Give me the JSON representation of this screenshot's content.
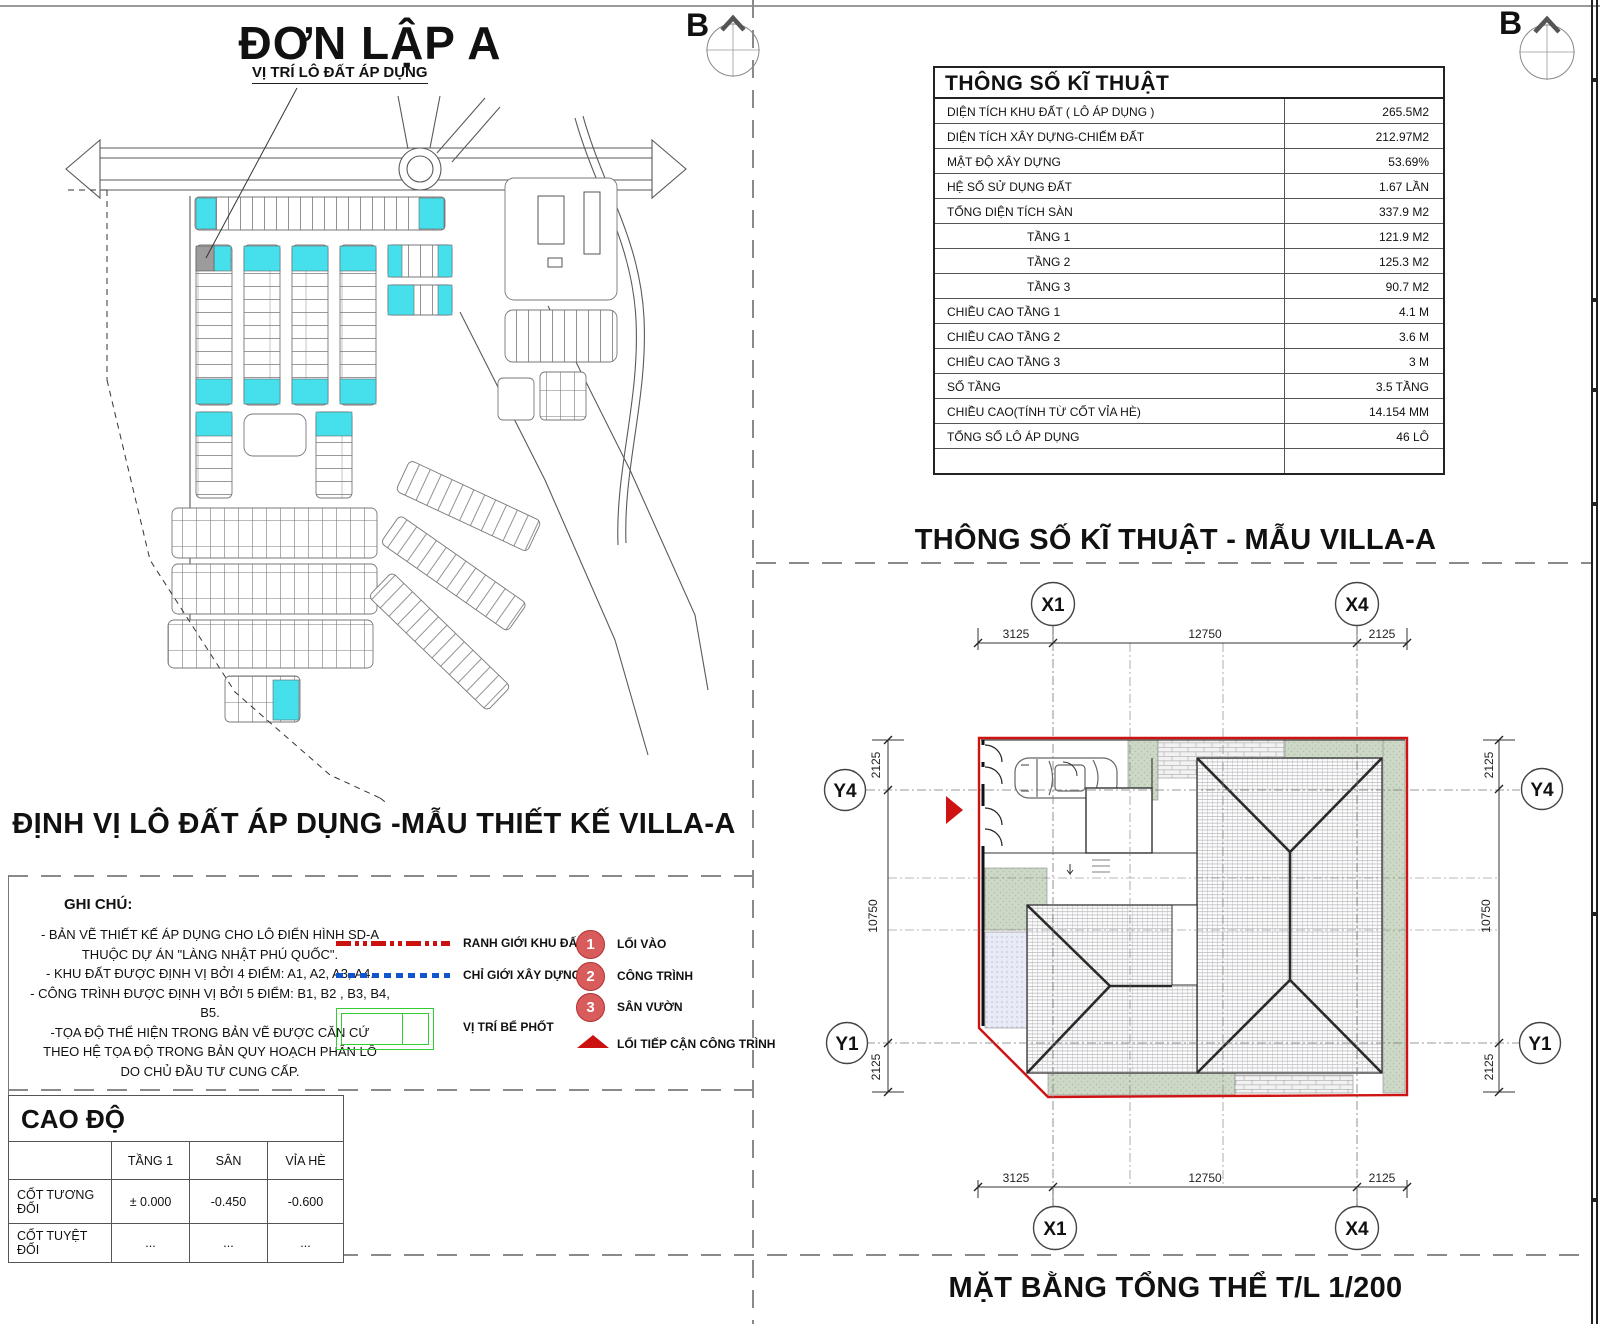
{
  "meta": {
    "north_label": "B"
  },
  "colors": {
    "highlight_lot_cyan": "#45E0EC",
    "selected_lot_gray": "#9C9C9C",
    "boundary_red": "#CF1212",
    "building_line_blue": "#1155CC",
    "septic_green": "#33CC33",
    "garden_sage": "#CDD8C6"
  },
  "left": {
    "title": "ĐƠN LẬP A",
    "map_label": "VỊ TRÍ LÔ ĐẤT ÁP DỤNG",
    "heading": "ĐỊNH VỊ LÔ ĐẤT ÁP DỤNG -MẪU THIẾT KẾ  VILLA-A",
    "notes": {
      "title": "GHI CHÚ:",
      "lines": [
        "- BẢN VẼ THIẾT KẾ ÁP DỤNG CHO LÔ ĐIỂN HÌNH SD-A",
        "THUỘC DỰ ÁN \"LÀNG NHẬT PHÚ QUỐC\".",
        "- KHU ĐẤT ĐƯỢC ĐỊNH VỊ BỞI 4 ĐIỂM: A1, A2, A3, A4.",
        "- CÔNG TRÌNH ĐƯỢC ĐỊNH VỊ BỞI 5 ĐIỂM: B1, B2 , B3, B4, B5.",
        "-TỌA ĐỘ THỂ HIỆN TRONG BẢN VẼ ĐƯỢC CĂN CỨ",
        "THEO HỆ TỌA ĐỘ TRONG BẢN QUY HOẠCH PHÂN LÔ",
        "DO CHỦ ĐẦU TƯ CUNG CẤP."
      ]
    },
    "legend": {
      "boundary": "RANH GIỚI KHU ĐẤT",
      "building_line": "CHỈ GIỚI XÂY DỰNG",
      "septic": "VỊ TRÍ BỂ PHỐT",
      "numbered": [
        {
          "num": "1",
          "label": "LỐI VÀO"
        },
        {
          "num": "2",
          "label": "CÔNG TRÌNH"
        },
        {
          "num": "3",
          "label": "SÂN VƯỜN"
        }
      ],
      "access": "LỐI TIẾP CẬN CÔNG TRÌNH"
    },
    "cao_do": {
      "title": "CAO ĐỘ",
      "col_headers": [
        "",
        "TẦNG 1",
        "SÂN",
        "VỈA HÈ"
      ],
      "rows": [
        {
          "label": "CỐT TƯƠNG ĐỐI",
          "values": [
            "± 0.000",
            "-0.450",
            "-0.600"
          ]
        },
        {
          "label": "CỐT TUYỆT ĐỐI",
          "values": [
            "...",
            "...",
            "..."
          ]
        }
      ]
    }
  },
  "right": {
    "specs": {
      "title": "THÔNG SỐ KĨ THUẬT",
      "rows": [
        {
          "label": "DIỆN TÍCH KHU ĐẤT ( LÔ ÁP DỤNG )",
          "value": "265.5M2"
        },
        {
          "label": "DIỆN TÍCH XÂY DỰNG-CHIẾM ĐẤT",
          "value": "212.97M2"
        },
        {
          "label": "MẬT ĐỘ XÂY DỰNG",
          "value": "53.69%"
        },
        {
          "label": "HỆ SỐ SỬ DỤNG ĐẤT",
          "value": "1.67 LẦN"
        },
        {
          "label": "TỔNG DIỆN TÍCH SÀN",
          "value": "337.9 M2"
        },
        {
          "label": "TẦNG 1",
          "value": "121.9 M2"
        },
        {
          "label": "TẦNG 2",
          "value": "125.3 M2"
        },
        {
          "label": "TẦNG 3",
          "value": "90.7 M2"
        },
        {
          "label": "CHIỀU CAO TẦNG 1",
          "value": "4.1 M"
        },
        {
          "label": "CHIỀU CAO TẦNG 2",
          "value": "3.6 M"
        },
        {
          "label": "CHIỀU CAO TẦNG 3",
          "value": "3 M"
        },
        {
          "label": "SỐ TẦNG",
          "value": "3.5 TẦNG"
        },
        {
          "label": "CHIỀU CAO(TÍNH TỪ CỐT VỈA HÈ)",
          "value": "14.154 MM"
        },
        {
          "label": "TỔNG SỐ LÔ ÁP DỤNG",
          "value": "46 LÔ"
        }
      ]
    },
    "specs_heading": "THÔNG SỐ KĨ THUẬT - MẪU VILLA-A",
    "plan": {
      "grid_x": [
        "X1",
        "X4"
      ],
      "grid_y": [
        "Y4",
        "Y1"
      ],
      "dims_top": [
        "3125",
        "12750",
        "2125"
      ],
      "dims_bottom": [
        "3125",
        "12750",
        "2125"
      ],
      "dims_left": [
        "2125",
        "10750",
        "2125"
      ],
      "dims_right": [
        "2125",
        "10750",
        "2125"
      ]
    },
    "bottom_title": "MẶT BẰNG TỔNG THỂ T/L 1/200"
  }
}
